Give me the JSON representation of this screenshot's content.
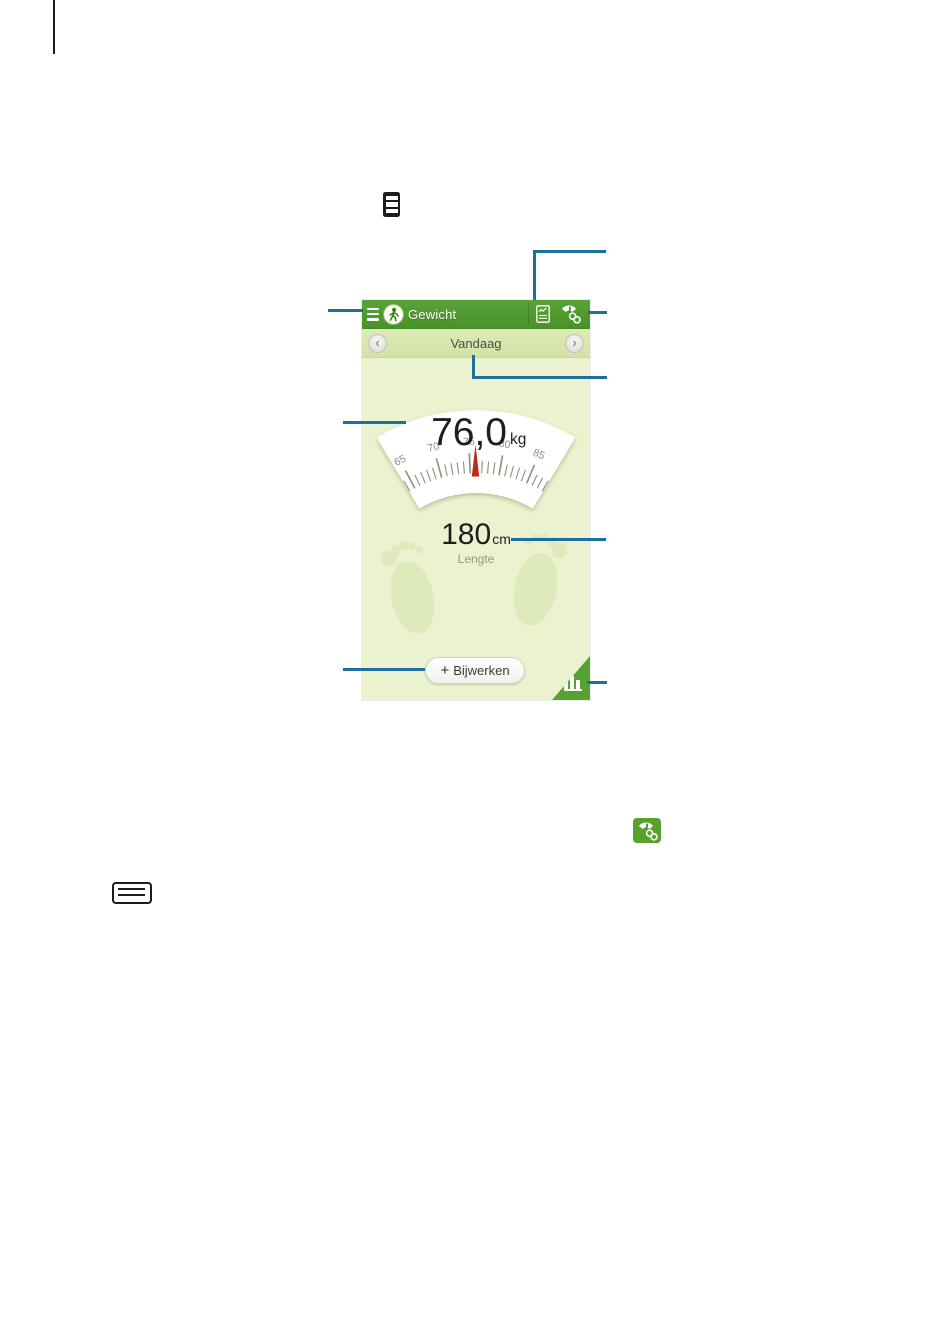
{
  "colors": {
    "header_green": "#4f9b2e",
    "date_bar_green": "#d9e7b0",
    "body_green": "#eaf2cf",
    "accent_green": "#57a22f",
    "footprint_green": "#dfeabc",
    "callout_blue": "#1e6f9f",
    "needle_red": "#c1271b"
  },
  "icons": {
    "inline_manual_icon": "weight-menu-icon",
    "hardware_key": "menu-key-icon",
    "header_left": "drawer-menu-icon",
    "header_badge": "pedestrian-icon",
    "header_action_1": "journal-chart-icon",
    "header_action_2": "scale-link-icon",
    "corner": "bar-chart-icon"
  },
  "app": {
    "header": {
      "title": "Gewicht"
    },
    "date_nav": {
      "label": "Vandaag",
      "prev_glyph": "‹",
      "next_glyph": "›"
    },
    "dial": {
      "value": "76,0",
      "unit": "kg",
      "tick_labels": [
        "65",
        "70",
        "75",
        "80",
        "85"
      ]
    },
    "height": {
      "value": "180",
      "unit": "cm",
      "caption": "Lengte"
    },
    "update_button": {
      "plus": "+",
      "label": "Bijwerken"
    }
  }
}
